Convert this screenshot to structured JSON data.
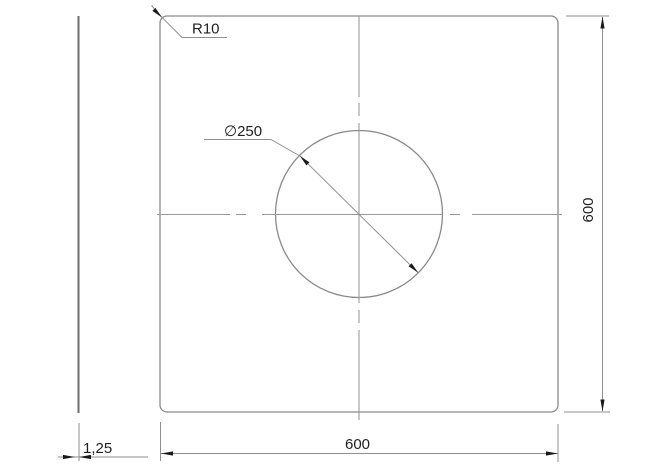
{
  "drawing": {
    "title": "plate-drawing-600x600",
    "labels": {
      "corner_radius": "R10",
      "hole_diameter": "∅250",
      "plate_height": "600",
      "plate_width": "600",
      "thickness": "1,25"
    },
    "colors": {
      "background": "#ffffff",
      "geometry_line": "#8a8a8a",
      "centerline": "#9a9a9a",
      "annotation_text": "#1f1f1f",
      "arrowhead": "#1a1a1a"
    }
  }
}
